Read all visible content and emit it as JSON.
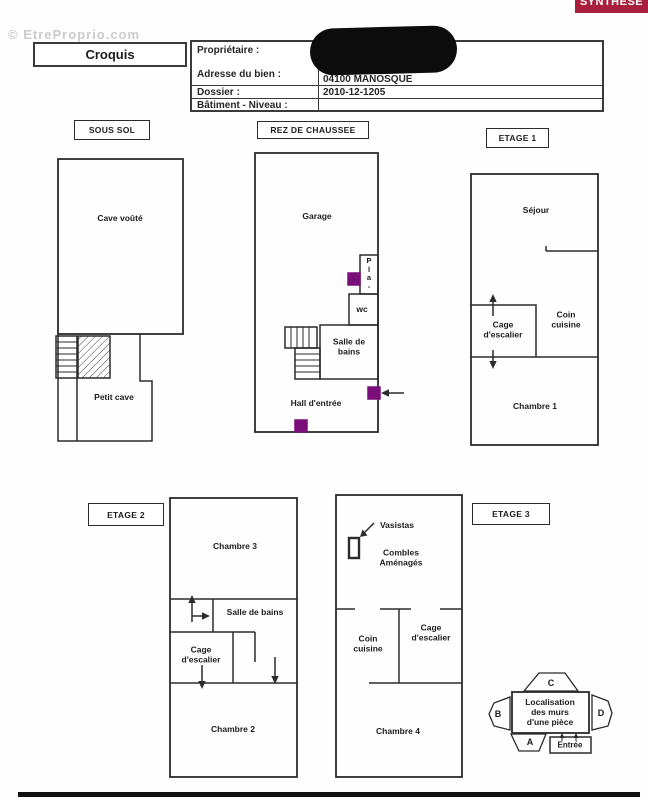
{
  "watermark": {
    "text": "© EtreProprio.com"
  },
  "badge": {
    "label": "SYNTHÈSE"
  },
  "header": {
    "title": "Croquis",
    "proprietaire_label": "Propriétaire :",
    "adresse_label": "Adresse du bien :",
    "adresse_value": "04100 MANOSQUE",
    "dossier_label": "Dossier :",
    "dossier_value": "2010-12-1205",
    "batiment_label": "Bâtiment - Niveau :"
  },
  "floor_tags": {
    "sous_sol": "SOUS SOL",
    "rdc": "REZ DE CHAUSSEE",
    "etage1": "ETAGE 1",
    "etage2": "ETAGE 2",
    "etage3": "ETAGE 3"
  },
  "rooms": {
    "cave_voute": "Cave voûté",
    "petit_cave": "Petit cave",
    "garage": "Garage",
    "placard": "P\nl\na\n-",
    "wc": "wc",
    "salle_de_bains_multiline": "Salle de\nbains",
    "hall_entree": "Hall d'entrée",
    "sejour": "Séjour",
    "coin_cuisine": "Coin\ncuisine",
    "cage_escalier": "Cage\nd'escalier",
    "chambre1": "Chambre 1",
    "chambre2": "Chambre 2",
    "chambre3": "Chambre 3",
    "chambre4": "Chambre 4",
    "salle_de_bains": "Salle de bains",
    "vasistas": "Vasistas",
    "combles": "Combles\nAménagés"
  },
  "legend": {
    "title": "Localisation\ndes murs\nd'une pièce",
    "wall_a": "A",
    "wall_b": "B",
    "wall_c": "C",
    "wall_d": "D",
    "entree": "Entrée"
  },
  "colors": {
    "badge_bg": "#a81e3c",
    "marker_purple": "#7a0f7a",
    "wall": "#2b2b2b"
  }
}
